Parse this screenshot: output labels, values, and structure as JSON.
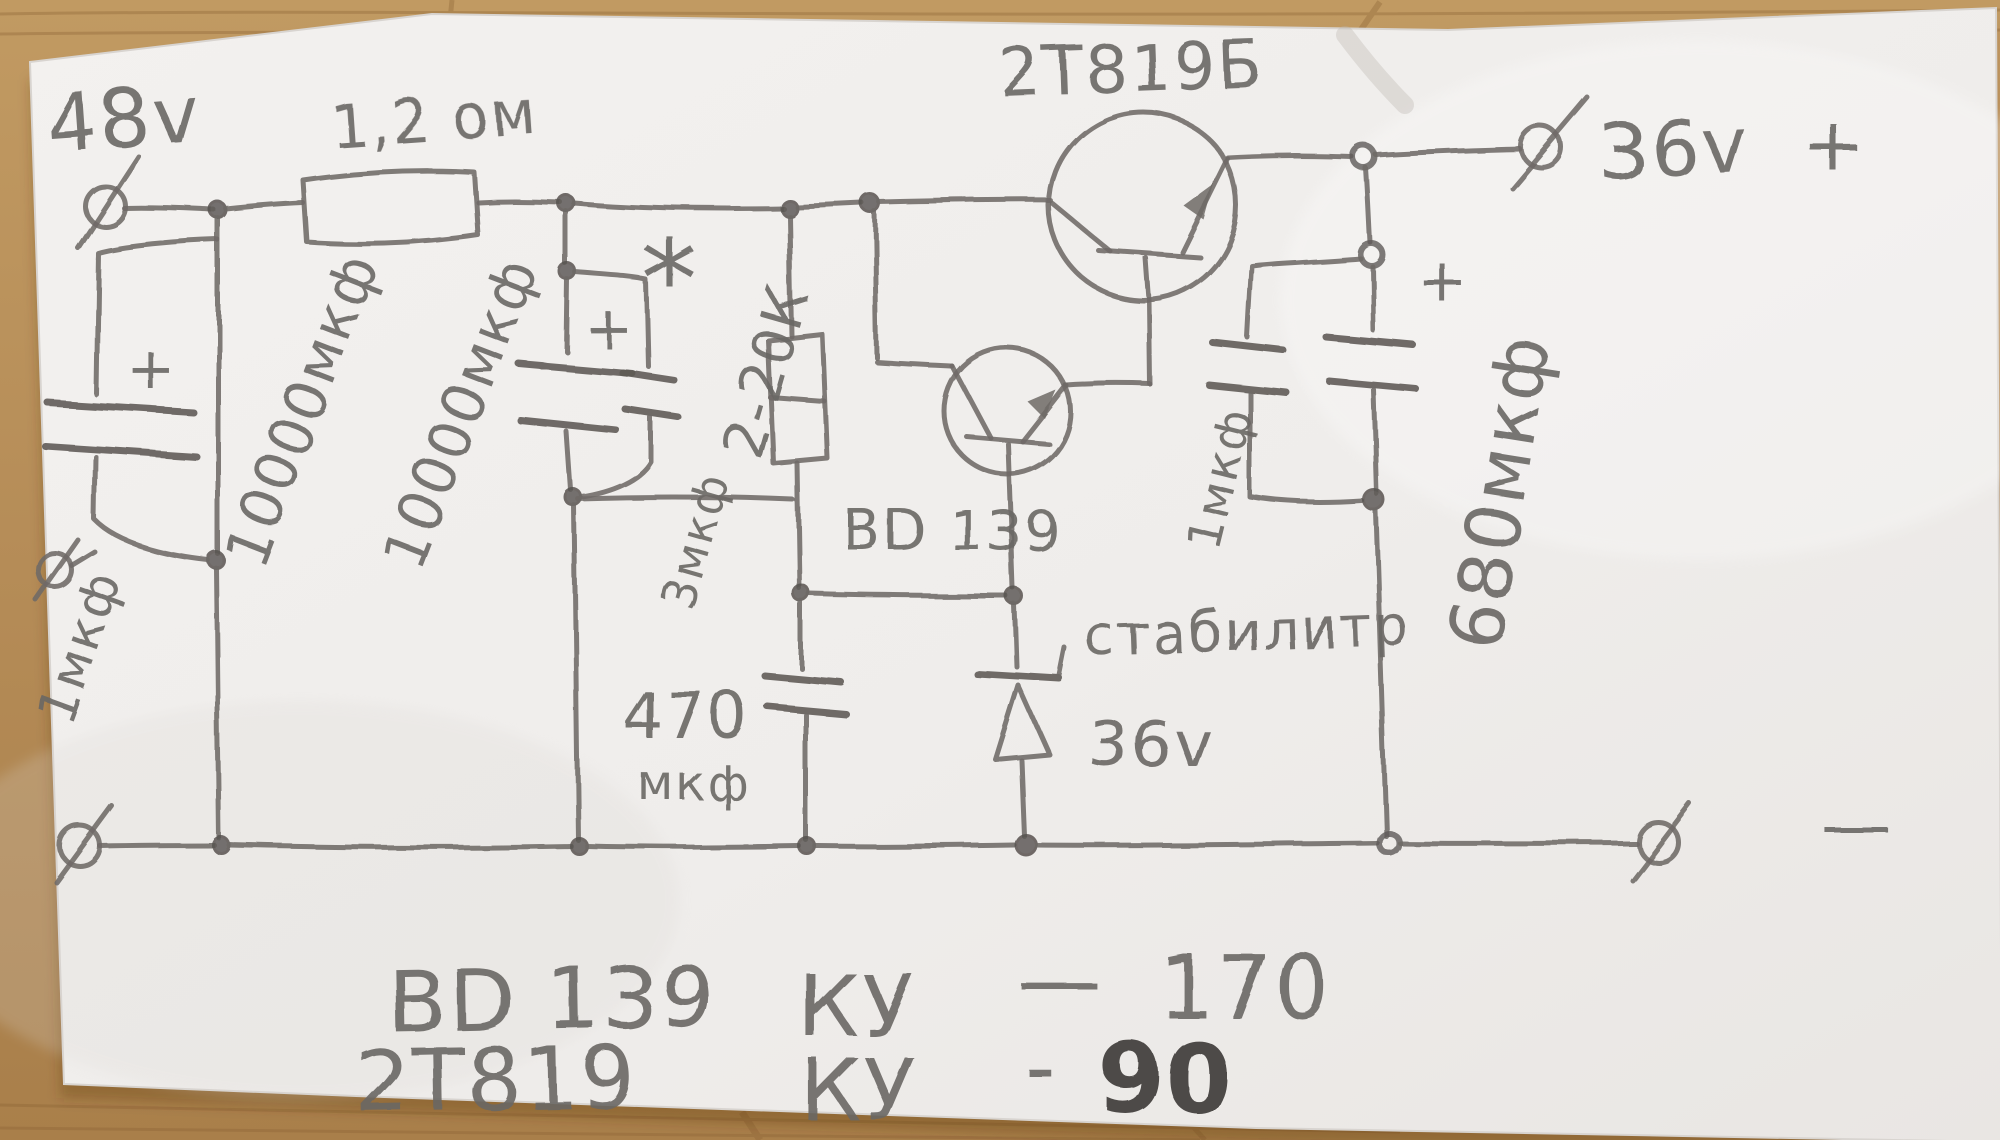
{
  "palette": {
    "wood": "#b58c57",
    "wood_dark": "#96713f",
    "paper": "#f1efed",
    "pencil": "#6b6764"
  },
  "labels": {
    "input_voltage": "48v",
    "r1_value": "1,2 ом",
    "c1_plus": "+",
    "c1_value": "1мкф",
    "c2_value": "10000мкф",
    "c3_value": "10000мкф",
    "c3_plus": "+",
    "c4_value": "3мкф",
    "r2_mark": "*",
    "r2_value": "2-20К",
    "q1_name": "2Т819Б",
    "q2_name": "BD 139",
    "c5_value_line1": "470",
    "c5_value_line2": "мкф",
    "zener_name": "стабилитр",
    "zener_voltage": "36v",
    "c6_value": "1мкф",
    "c7_plus": "+",
    "c7_value": "680мкф",
    "output_voltage": "36v",
    "output_plus": "+",
    "output_minus": "—"
  },
  "notes": {
    "line1": {
      "part": "BD 139",
      "param": "КУ",
      "dash": "—",
      "value": "170"
    },
    "line2": {
      "part": "2Т819",
      "param": "КУ",
      "dash": "-",
      "value": "90"
    }
  }
}
